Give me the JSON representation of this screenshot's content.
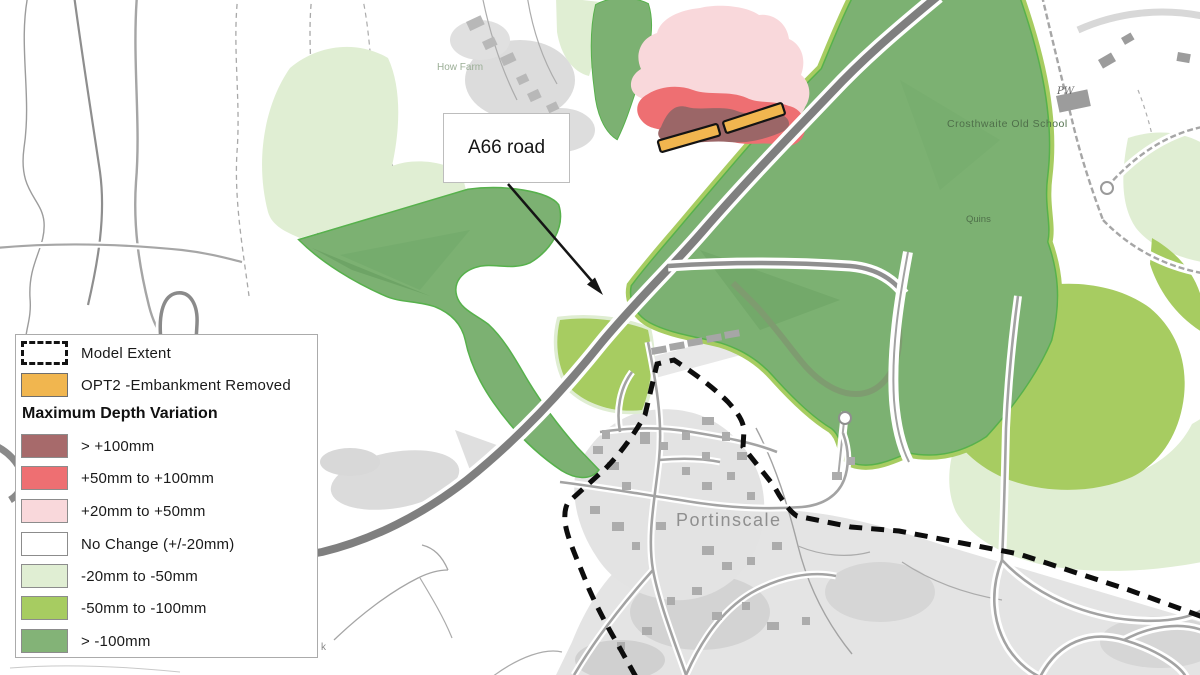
{
  "legend": {
    "model_extent": {
      "label": "Model Extent"
    },
    "opt2": {
      "label": "OPT2 -Embankment Removed",
      "color": "#F1B64F"
    },
    "section_title": "Maximum Depth Variation",
    "items": [
      {
        "label": "> +100mm",
        "color": "#A76A6B"
      },
      {
        "label": "+50mm to +100mm",
        "color": "#EE6F72"
      },
      {
        "label": "+20mm to +50mm",
        "color": "#F9D8DB"
      },
      {
        "label": "No Change (+/-20mm)",
        "color": "#FFFFFF"
      },
      {
        "label": "-20mm to -50mm",
        "color": "#E0EED3"
      },
      {
        "label": "-50mm to -100mm",
        "color": "#A7CC61"
      },
      {
        "label": "> -100mm",
        "color": "#83B377"
      }
    ]
  },
  "annotation": {
    "label": "A66 road"
  },
  "map_labels": {
    "farm": "How Farm",
    "school": "Crosthwaite Old School",
    "quins": "Quins",
    "pw": "PW",
    "village": "Portinscale",
    "partial": "k"
  },
  "colors": {
    "increase_high": "#9B6667",
    "increase_mid": "#EE6F72",
    "increase_low": "#F9D8DB",
    "decrease_low": "#E0EED3",
    "decrease_mid": "#A7CC61",
    "decrease_high": "#7CB172",
    "embankment": "#F1B64F",
    "model_extent_line": "#0D0D0D",
    "road_major": "#7F7F7F"
  }
}
